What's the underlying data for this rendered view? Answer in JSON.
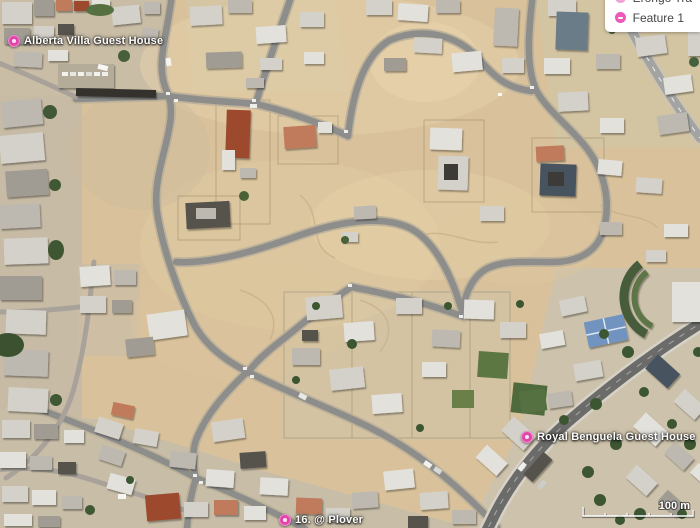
{
  "legend": {
    "items": [
      {
        "label": "Erongo Tra",
        "truncated": true
      },
      {
        "label": "Feature 1",
        "truncated": false
      }
    ]
  },
  "places": [
    {
      "name": "Alberta Villa Guest House"
    },
    {
      "name": "Royal Benguela Guest House"
    },
    {
      "name": "16. @ Plover"
    }
  ],
  "scale": {
    "label": "100 m"
  },
  "colors": {
    "accent_magenta": "#e246ab",
    "place_label_text": "#ffffff",
    "panel_text": "#454545",
    "sand": "#d9c29b",
    "road": "#8d8d8b",
    "avenue": "#6b6b69",
    "vegetation": "#46603a",
    "roof_red": "#9c4a2f",
    "roof_white": "#e3e1db"
  }
}
